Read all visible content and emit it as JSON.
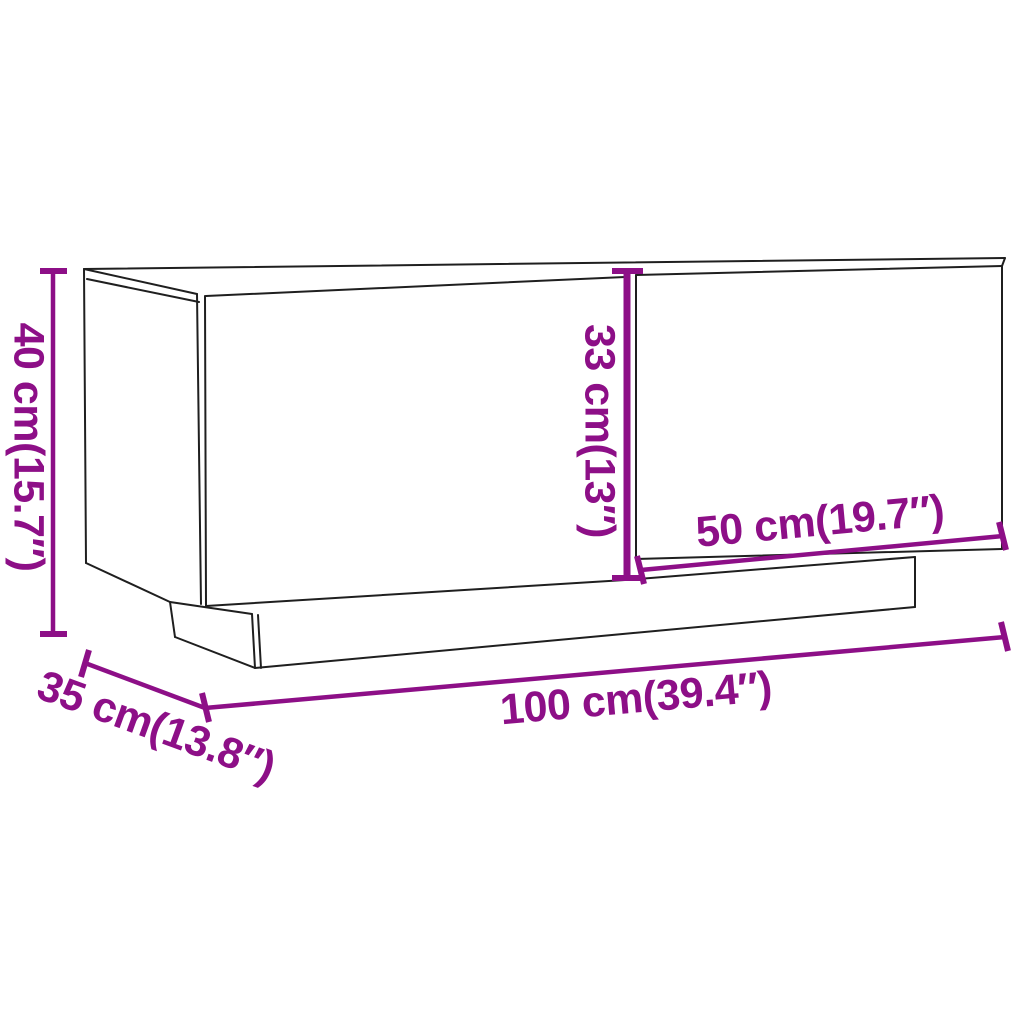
{
  "drawing": {
    "subject": "TV cabinet with two doors on recessed plinth, perspective line drawing"
  },
  "labels": {
    "height": "40 cm(15.7″)",
    "depth": "35 cm(13.8″)",
    "width": "100 cm(39.4″)",
    "door_width": "50 cm(19.7″)",
    "door_height": "33 cm(13″)"
  },
  "colors": {
    "dimension": "#8d0f87",
    "outline": "#1f1f1f",
    "background": "#ffffff"
  }
}
